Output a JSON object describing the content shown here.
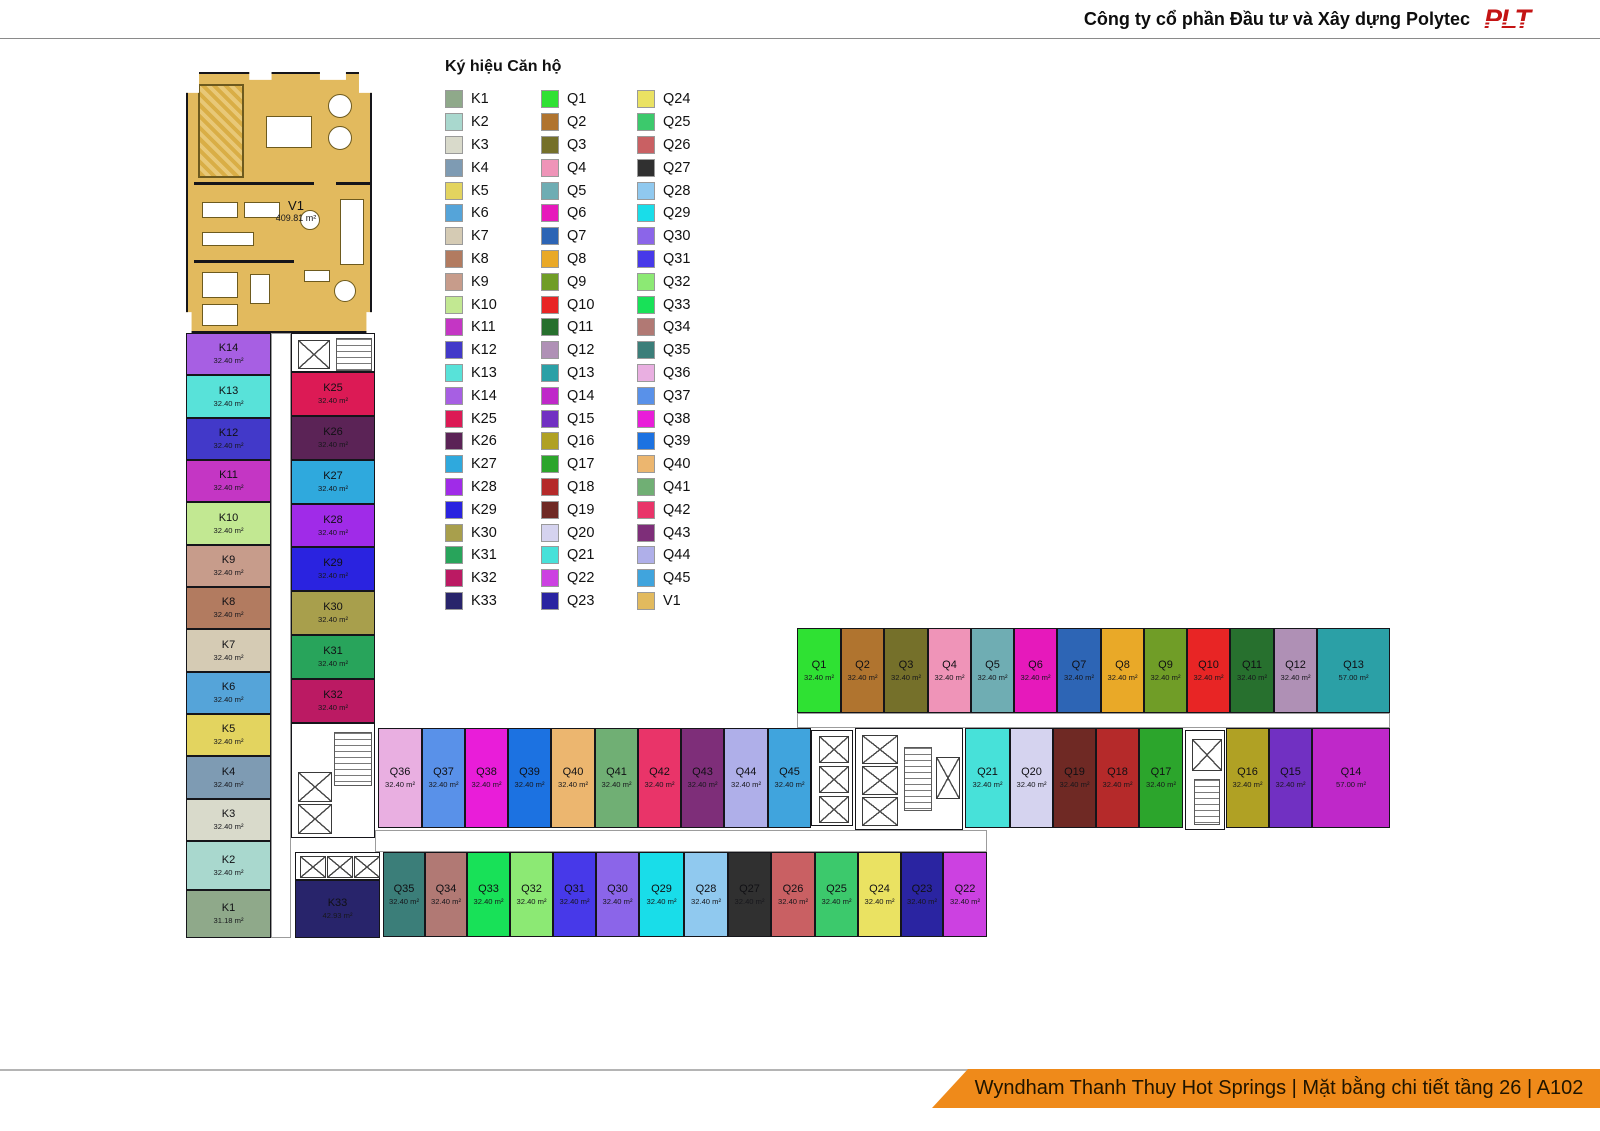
{
  "header": {
    "company": "Công ty cổ phần Đầu tư và Xây dựng Polytec",
    "logo": "PLT"
  },
  "footer": {
    "banner": "Wyndham Thanh Thuy Hot Springs | Mặt bằng chi tiết tầng 26 | A102"
  },
  "legend": {
    "title": "Ký hiệu Căn hộ",
    "columns": [
      [
        "K1",
        "K2",
        "K3",
        "K4",
        "K5",
        "K6",
        "K7",
        "K8",
        "K9",
        "K10",
        "K11",
        "K12",
        "K13",
        "K14",
        "K25",
        "K26",
        "K27",
        "K28",
        "K29",
        "K30",
        "K31",
        "K32",
        "K33"
      ],
      [
        "Q1",
        "Q2",
        "Q3",
        "Q4",
        "Q5",
        "Q6",
        "Q7",
        "Q8",
        "Q9",
        "Q10",
        "Q11",
        "Q12",
        "Q13",
        "Q14",
        "Q15",
        "Q16",
        "Q17",
        "Q18",
        "Q19",
        "Q20",
        "Q21",
        "Q22",
        "Q23"
      ],
      [
        "Q24",
        "Q25",
        "Q26",
        "Q27",
        "Q28",
        "Q29",
        "Q30",
        "Q31",
        "Q32",
        "Q33",
        "Q34",
        "Q35",
        "Q36",
        "Q37",
        "Q38",
        "Q39",
        "Q40",
        "Q41",
        "Q42",
        "Q43",
        "Q44",
        "Q45",
        "V1"
      ]
    ]
  },
  "colors": {
    "K1": "#8fa98a",
    "K2": "#a9d8ce",
    "K3": "#d9dacb",
    "K4": "#7e9bb3",
    "K5": "#e3d45f",
    "K6": "#55a4d9",
    "K7": "#d5cbb4",
    "K8": "#b27b60",
    "K9": "#c79c8b",
    "K10": "#c2e892",
    "K11": "#c436c4",
    "K12": "#4239c9",
    "K13": "#58e2d9",
    "K14": "#a75fe3",
    "K25": "#dc1a55",
    "K26": "#5b2356",
    "K27": "#2fa9dd",
    "K28": "#a02be8",
    "K29": "#2a23e0",
    "K30": "#a89f4c",
    "K31": "#28a45b",
    "K32": "#bb1a63",
    "K33": "#28246b",
    "Q1": "#2fe133",
    "Q2": "#b0742f",
    "Q3": "#75702a",
    "Q4": "#ef94b8",
    "Q5": "#6fadb3",
    "Q6": "#e619bb",
    "Q7": "#2d65b5",
    "Q8": "#e9a928",
    "Q9": "#709d27",
    "Q10": "#e82525",
    "Q11": "#27702e",
    "Q12": "#af90b5",
    "Q13": "#2ba0a6",
    "Q14": "#bf28c9",
    "Q15": "#7130c2",
    "Q16": "#b0a124",
    "Q17": "#2ca52c",
    "Q18": "#b52a2a",
    "Q19": "#6f2924",
    "Q20": "#d5d3ef",
    "Q21": "#47e1d9",
    "Q22": "#cc41e1",
    "Q23": "#2a24a1",
    "Q24": "#eae262",
    "Q25": "#3cc96c",
    "Q26": "#c96063",
    "Q27": "#303030",
    "Q28": "#90c9ef",
    "Q29": "#19dde9",
    "Q30": "#8b65e9",
    "Q31": "#4739e9",
    "Q32": "#8ce974",
    "Q33": "#18e158",
    "Q34": "#b17974",
    "Q35": "#3b7e79",
    "Q36": "#e9afe1",
    "Q37": "#5991e9",
    "Q38": "#e91dd9",
    "Q39": "#1c72e1",
    "Q40": "#ecb66f",
    "Q41": "#70af74",
    "Q42": "#e93469",
    "Q43": "#7e2e79",
    "Q44": "#afafe9",
    "Q45": "#40a4dd",
    "V1": "#e2ba5e"
  },
  "plan": {
    "v1": {
      "id": "V1",
      "area": "409.81 m²"
    },
    "units": [
      {
        "id": "K14",
        "area": "32.40 m²",
        "x": 186,
        "y": 333,
        "w": 85,
        "h": 42
      },
      {
        "id": "K13",
        "area": "32.40 m²",
        "x": 186,
        "y": 375,
        "w": 85,
        "h": 43
      },
      {
        "id": "K12",
        "area": "32.40 m²",
        "x": 186,
        "y": 418,
        "w": 85,
        "h": 42
      },
      {
        "id": "K11",
        "area": "32.40 m²",
        "x": 186,
        "y": 460,
        "w": 85,
        "h": 42
      },
      {
        "id": "K10",
        "area": "32.40 m²",
        "x": 186,
        "y": 502,
        "w": 85,
        "h": 43
      },
      {
        "id": "K9",
        "area": "32.40 m²",
        "x": 186,
        "y": 545,
        "w": 85,
        "h": 42
      },
      {
        "id": "K8",
        "area": "32.40 m²",
        "x": 186,
        "y": 587,
        "w": 85,
        "h": 42
      },
      {
        "id": "K7",
        "area": "32.40 m²",
        "x": 186,
        "y": 629,
        "w": 85,
        "h": 43
      },
      {
        "id": "K6",
        "area": "32.40 m²",
        "x": 186,
        "y": 672,
        "w": 85,
        "h": 42
      },
      {
        "id": "K5",
        "area": "32.40 m²",
        "x": 186,
        "y": 714,
        "w": 85,
        "h": 42
      },
      {
        "id": "K4",
        "area": "32.40 m²",
        "x": 186,
        "y": 756,
        "w": 85,
        "h": 43
      },
      {
        "id": "K3",
        "area": "32.40 m²",
        "x": 186,
        "y": 799,
        "w": 85,
        "h": 42
      },
      {
        "id": "K2",
        "area": "32.40 m²",
        "x": 186,
        "y": 841,
        "w": 85,
        "h": 49
      },
      {
        "id": "K1",
        "area": "31.18 m²",
        "x": 186,
        "y": 890,
        "w": 85,
        "h": 48
      },
      {
        "id": "K25",
        "area": "32.40 m²",
        "x": 291,
        "y": 372,
        "w": 84,
        "h": 44
      },
      {
        "id": "K26",
        "area": "32.40 m²",
        "x": 291,
        "y": 416,
        "w": 84,
        "h": 44
      },
      {
        "id": "K27",
        "area": "32.40 m²",
        "x": 291,
        "y": 460,
        "w": 84,
        "h": 44
      },
      {
        "id": "K28",
        "area": "32.40 m²",
        "x": 291,
        "y": 504,
        "w": 84,
        "h": 43
      },
      {
        "id": "K29",
        "area": "32.40 m²",
        "x": 291,
        "y": 547,
        "w": 84,
        "h": 44
      },
      {
        "id": "K30",
        "area": "32.40 m²",
        "x": 291,
        "y": 591,
        "w": 84,
        "h": 44
      },
      {
        "id": "K31",
        "area": "32.40 m²",
        "x": 291,
        "y": 635,
        "w": 84,
        "h": 44
      },
      {
        "id": "K32",
        "area": "32.40 m²",
        "x": 291,
        "y": 679,
        "w": 84,
        "h": 44
      },
      {
        "id": "K33",
        "area": "42.93 m²",
        "x": 295,
        "y": 880,
        "w": 85,
        "h": 58
      },
      {
        "id": "Q35",
        "area": "32.40 m²",
        "x": 383,
        "y": 852,
        "w": 42,
        "h": 85
      },
      {
        "id": "Q34",
        "area": "32.40 m²",
        "x": 425,
        "y": 852,
        "w": 42,
        "h": 85
      },
      {
        "id": "Q33",
        "area": "32.40 m²",
        "x": 467,
        "y": 852,
        "w": 43,
        "h": 85
      },
      {
        "id": "Q32",
        "area": "32.40 m²",
        "x": 510,
        "y": 852,
        "w": 43,
        "h": 85
      },
      {
        "id": "Q31",
        "area": "32.40 m²",
        "x": 553,
        "y": 852,
        "w": 43,
        "h": 85
      },
      {
        "id": "Q30",
        "area": "32.40 m²",
        "x": 596,
        "y": 852,
        "w": 43,
        "h": 85
      },
      {
        "id": "Q29",
        "area": "32.40 m²",
        "x": 639,
        "y": 852,
        "w": 45,
        "h": 85
      },
      {
        "id": "Q28",
        "area": "32.40 m²",
        "x": 684,
        "y": 852,
        "w": 44,
        "h": 85
      },
      {
        "id": "Q27",
        "area": "32.40 m²",
        "x": 728,
        "y": 852,
        "w": 43,
        "h": 85
      },
      {
        "id": "Q26",
        "area": "32.40 m²",
        "x": 771,
        "y": 852,
        "w": 44,
        "h": 85
      },
      {
        "id": "Q25",
        "area": "32.40 m²",
        "x": 815,
        "y": 852,
        "w": 43,
        "h": 85
      },
      {
        "id": "Q24",
        "area": "32.40 m²",
        "x": 858,
        "y": 852,
        "w": 43,
        "h": 85
      },
      {
        "id": "Q23",
        "area": "32.40 m²",
        "x": 901,
        "y": 852,
        "w": 42,
        "h": 85
      },
      {
        "id": "Q22",
        "area": "32.40 m²",
        "x": 943,
        "y": 852,
        "w": 44,
        "h": 85
      },
      {
        "id": "Q36",
        "area": "32.40 m²",
        "x": 378,
        "y": 728,
        "w": 44,
        "h": 100
      },
      {
        "id": "Q37",
        "area": "32.40 m²",
        "x": 422,
        "y": 728,
        "w": 43,
        "h": 100
      },
      {
        "id": "Q38",
        "area": "32.40 m²",
        "x": 465,
        "y": 728,
        "w": 43,
        "h": 100
      },
      {
        "id": "Q39",
        "area": "32.40 m²",
        "x": 508,
        "y": 728,
        "w": 43,
        "h": 100
      },
      {
        "id": "Q40",
        "area": "32.40 m²",
        "x": 551,
        "y": 728,
        "w": 44,
        "h": 100
      },
      {
        "id": "Q41",
        "area": "32.40 m²",
        "x": 595,
        "y": 728,
        "w": 43,
        "h": 100
      },
      {
        "id": "Q42",
        "area": "32.40 m²",
        "x": 638,
        "y": 728,
        "w": 43,
        "h": 100
      },
      {
        "id": "Q43",
        "area": "32.40 m²",
        "x": 681,
        "y": 728,
        "w": 43,
        "h": 100
      },
      {
        "id": "Q44",
        "area": "32.40 m²",
        "x": 724,
        "y": 728,
        "w": 44,
        "h": 100
      },
      {
        "id": "Q45",
        "area": "32.40 m²",
        "x": 768,
        "y": 728,
        "w": 43,
        "h": 100
      },
      {
        "id": "Q21",
        "area": "32.40 m²",
        "x": 965,
        "y": 728,
        "w": 45,
        "h": 100
      },
      {
        "id": "Q20",
        "area": "32.40 m²",
        "x": 1010,
        "y": 728,
        "w": 43,
        "h": 100
      },
      {
        "id": "Q19",
        "area": "32.40 m²",
        "x": 1053,
        "y": 728,
        "w": 43,
        "h": 100
      },
      {
        "id": "Q18",
        "area": "32.40 m²",
        "x": 1096,
        "y": 728,
        "w": 43,
        "h": 100
      },
      {
        "id": "Q17",
        "area": "32.40 m²",
        "x": 1139,
        "y": 728,
        "w": 44,
        "h": 100
      },
      {
        "id": "Q16",
        "area": "32.40 m²",
        "x": 1226,
        "y": 728,
        "w": 43,
        "h": 100
      },
      {
        "id": "Q15",
        "area": "32.40 m²",
        "x": 1269,
        "y": 728,
        "w": 43,
        "h": 100
      },
      {
        "id": "Q14",
        "area": "57.00 m²",
        "x": 1312,
        "y": 728,
        "w": 78,
        "h": 100
      },
      {
        "id": "Q1",
        "area": "32.40 m²",
        "x": 797,
        "y": 628,
        "w": 44,
        "h": 85
      },
      {
        "id": "Q2",
        "area": "32.40 m²",
        "x": 841,
        "y": 628,
        "w": 43,
        "h": 85
      },
      {
        "id": "Q3",
        "area": "32.40 m²",
        "x": 884,
        "y": 628,
        "w": 44,
        "h": 85
      },
      {
        "id": "Q4",
        "area": "32.40 m²",
        "x": 928,
        "y": 628,
        "w": 43,
        "h": 85
      },
      {
        "id": "Q5",
        "area": "32.40 m²",
        "x": 971,
        "y": 628,
        "w": 43,
        "h": 85
      },
      {
        "id": "Q6",
        "area": "32.40 m²",
        "x": 1014,
        "y": 628,
        "w": 43,
        "h": 85
      },
      {
        "id": "Q7",
        "area": "32.40 m²",
        "x": 1057,
        "y": 628,
        "w": 44,
        "h": 85
      },
      {
        "id": "Q8",
        "area": "32.40 m²",
        "x": 1101,
        "y": 628,
        "w": 43,
        "h": 85
      },
      {
        "id": "Q9",
        "area": "32.40 m²",
        "x": 1144,
        "y": 628,
        "w": 43,
        "h": 85
      },
      {
        "id": "Q10",
        "area": "32.40 m²",
        "x": 1187,
        "y": 628,
        "w": 43,
        "h": 85
      },
      {
        "id": "Q11",
        "area": "32.40 m²",
        "x": 1230,
        "y": 628,
        "w": 44,
        "h": 85
      },
      {
        "id": "Q12",
        "area": "32.40 m²",
        "x": 1274,
        "y": 628,
        "w": 43,
        "h": 85
      },
      {
        "id": "Q13",
        "area": "57.00 m²",
        "x": 1317,
        "y": 628,
        "w": 73,
        "h": 85
      }
    ],
    "cores": [
      {
        "x": 291,
        "y": 333,
        "w": 84,
        "h": 39,
        "items": [
          {
            "t": "elev",
            "x": 6,
            "y": 6,
            "w": 30,
            "h": 27
          },
          {
            "t": "stair",
            "x": 44,
            "y": 4,
            "w": 34,
            "h": 31
          }
        ]
      },
      {
        "x": 291,
        "y": 723,
        "w": 84,
        "h": 115,
        "items": [
          {
            "t": "stair",
            "x": 42,
            "y": 8,
            "w": 36,
            "h": 52
          },
          {
            "t": "elev",
            "x": 6,
            "y": 48,
            "w": 32,
            "h": 28
          },
          {
            "t": "elev",
            "x": 6,
            "y": 80,
            "w": 32,
            "h": 28
          }
        ]
      },
      {
        "x": 295,
        "y": 852,
        "w": 85,
        "h": 28,
        "items": [
          {
            "t": "elev",
            "x": 4,
            "y": 3,
            "w": 24,
            "h": 20
          },
          {
            "t": "elev",
            "x": 31,
            "y": 3,
            "w": 24,
            "h": 20
          },
          {
            "t": "elev",
            "x": 58,
            "y": 3,
            "w": 24,
            "h": 20
          }
        ]
      },
      {
        "x": 811,
        "y": 730,
        "w": 42,
        "h": 96,
        "items": [
          {
            "t": "elev",
            "x": 7,
            "y": 5,
            "w": 28,
            "h": 25
          },
          {
            "t": "elev",
            "x": 7,
            "y": 35,
            "w": 28,
            "h": 25
          },
          {
            "t": "elev",
            "x": 7,
            "y": 65,
            "w": 28,
            "h": 25
          }
        ]
      },
      {
        "x": 855,
        "y": 728,
        "w": 108,
        "h": 102,
        "items": [
          {
            "t": "elev",
            "x": 6,
            "y": 6,
            "w": 34,
            "h": 27
          },
          {
            "t": "elev",
            "x": 6,
            "y": 37,
            "w": 34,
            "h": 27
          },
          {
            "t": "elev",
            "x": 6,
            "y": 68,
            "w": 34,
            "h": 27
          },
          {
            "t": "stair",
            "x": 48,
            "y": 18,
            "w": 26,
            "h": 62
          },
          {
            "t": "elev",
            "x": 80,
            "y": 28,
            "w": 22,
            "h": 40
          }
        ]
      },
      {
        "x": 1185,
        "y": 730,
        "w": 40,
        "h": 100,
        "items": [
          {
            "t": "elev",
            "x": 6,
            "y": 8,
            "w": 28,
            "h": 30
          },
          {
            "t": "stair",
            "x": 8,
            "y": 48,
            "w": 24,
            "h": 44
          }
        ]
      }
    ]
  }
}
